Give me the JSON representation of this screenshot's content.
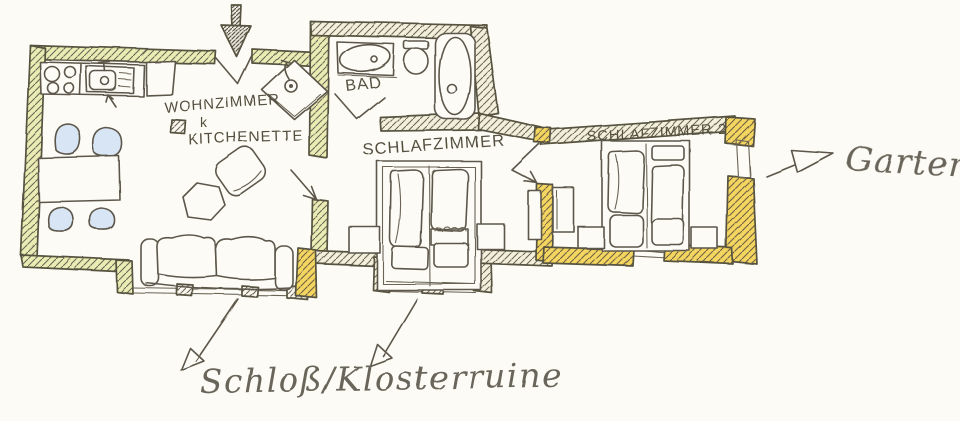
{
  "floor_plan": {
    "rooms": {
      "living": {
        "line1": "WOHNZIMMER",
        "line2": "k",
        "line3": "KITCHENETTE"
      },
      "bath": {
        "label": "BAD"
      },
      "bedroom1": {
        "label": "SCHLAFZIMMER"
      },
      "bedroom2": {
        "label": "SCHLAFZIMMER 2"
      }
    },
    "annotations": {
      "garden": {
        "label": "Garten",
        "arrow_direction": "right"
      },
      "castle": {
        "label": "Schloß/Klosterruine",
        "arrow_direction": "down-left"
      },
      "entrance": {
        "arrow_direction": "down"
      }
    },
    "colors": {
      "paper": "#fcfbf5",
      "ink": "#5d574b",
      "wall_highlight_green": "#e9edb4",
      "wall_highlight_yellow": "#f3d55f",
      "wall_pale": "#f2efda",
      "seat_blue": "#d7e5f4"
    }
  }
}
